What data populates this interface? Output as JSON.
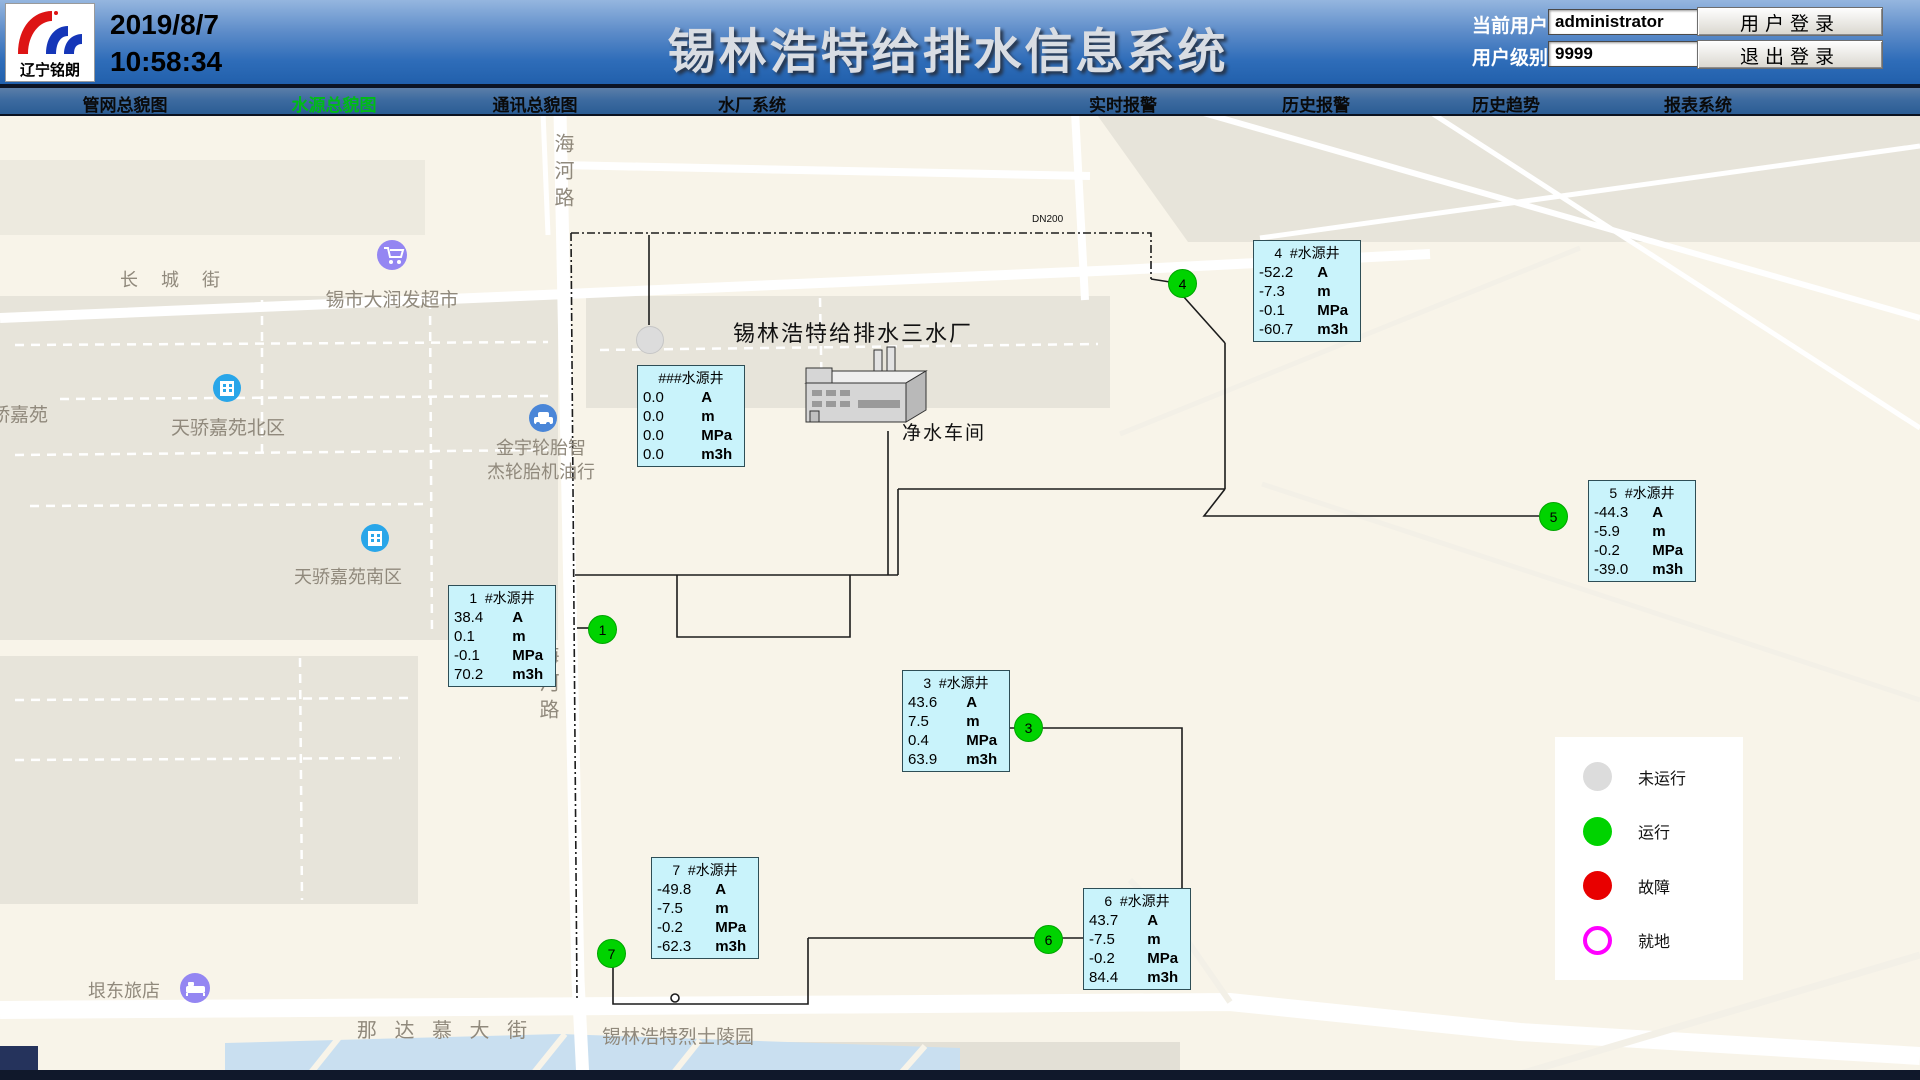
{
  "header": {
    "logo_text": "辽宁铭朗",
    "date": "2019/8/7",
    "time": "10:58:34",
    "title": "锡林浩特给排水信息系统",
    "current_user_label": "当前用户",
    "current_user_value": "administrator",
    "user_level_label": "用户级别",
    "user_level_value": "9999",
    "login_button": "用户登录",
    "logout_button": "退出登录"
  },
  "nav": {
    "items": [
      {
        "label": "管网总貌图",
        "active": false
      },
      {
        "label": "水源总貌图",
        "active": true
      },
      {
        "label": "通讯总貌图",
        "active": false
      },
      {
        "label": "水厂系统",
        "active": false
      },
      {
        "label": "实时报警",
        "active": false
      },
      {
        "label": "历史报警",
        "active": false
      },
      {
        "label": "历史趋势",
        "active": false
      },
      {
        "label": "报表系统",
        "active": false
      }
    ]
  },
  "plant": {
    "title": "锡林浩特给排水三水厂",
    "workshop_label": "净水车间",
    "pipe_label": "DN200"
  },
  "wells": [
    {
      "title": "###水源井",
      "rows": [
        {
          "v": "0.0",
          "u": "A"
        },
        {
          "v": "0.0",
          "u": "m"
        },
        {
          "v": "0.0",
          "u": "MPa"
        },
        {
          "v": "0.0",
          "u": "m3h"
        }
      ]
    },
    {
      "title": "1  #水源井",
      "rows": [
        {
          "v": "38.4",
          "u": "A"
        },
        {
          "v": "0.1",
          "u": "m"
        },
        {
          "v": "-0.1",
          "u": "MPa"
        },
        {
          "v": "70.2",
          "u": "m3h"
        }
      ]
    },
    {
      "title": "3  #水源井",
      "rows": [
        {
          "v": "43.6",
          "u": "A"
        },
        {
          "v": "7.5",
          "u": "m"
        },
        {
          "v": "0.4",
          "u": "MPa"
        },
        {
          "v": "63.9",
          "u": "m3h"
        }
      ]
    },
    {
      "title": "4  #水源井",
      "rows": [
        {
          "v": "-52.2",
          "u": "A"
        },
        {
          "v": "-7.3",
          "u": "m"
        },
        {
          "v": "-0.1",
          "u": "MPa"
        },
        {
          "v": "-60.7",
          "u": "m3h"
        }
      ]
    },
    {
      "title": "5  #水源井",
      "rows": [
        {
          "v": "-44.3",
          "u": "A"
        },
        {
          "v": "-5.9",
          "u": "m"
        },
        {
          "v": "-0.2",
          "u": "MPa"
        },
        {
          "v": "-39.0",
          "u": "m3h"
        }
      ]
    },
    {
      "title": "6  #水源井",
      "rows": [
        {
          "v": "43.7",
          "u": "A"
        },
        {
          "v": "-7.5",
          "u": "m"
        },
        {
          "v": "-0.2",
          "u": "MPa"
        },
        {
          "v": "84.4",
          "u": "m3h"
        }
      ]
    },
    {
      "title": "7  #水源井",
      "rows": [
        {
          "v": "-49.8",
          "u": "A"
        },
        {
          "v": "-7.5",
          "u": "m"
        },
        {
          "v": "-0.2",
          "u": "MPa"
        },
        {
          "v": "-62.3",
          "u": "m3h"
        }
      ]
    }
  ],
  "markers": {
    "m1": "1",
    "m3": "3",
    "m4": "4",
    "m5": "5",
    "m6": "6",
    "m7": "7"
  },
  "legend": {
    "items": [
      {
        "label": "未运行",
        "color": "#dcdcdc",
        "style": "filled"
      },
      {
        "label": "运行",
        "color": "#00d300",
        "style": "filled"
      },
      {
        "label": "故障",
        "color": "#e80000",
        "style": "filled"
      },
      {
        "label": "就地",
        "color": "#ff00ff",
        "style": "outline"
      }
    ]
  },
  "map": {
    "streets": {
      "changcheng": "长 城 街",
      "nadamu": "那 达 慕 大 街",
      "haihe": "海河路"
    },
    "pois": {
      "supermarket": "锡市大润发超市",
      "estate_west": "天骄嘉苑",
      "estate_north": "天骄嘉苑北区",
      "tire_shop_line1": "金宇轮胎智",
      "tire_shop_line2": "杰轮胎机油行",
      "estate_south": "天骄嘉苑南区",
      "hotel": "垠东旅店",
      "cemetery": "锡林浩特烈士陵园"
    }
  },
  "colors": {
    "well_box_bg": "#c9f3fb",
    "status_running": "#00d300",
    "status_stopped": "#dcdcdc",
    "status_fault": "#e80000",
    "status_local": "#ff00ff",
    "nav_active": "#00bb17",
    "header_blue": "#2f6db9",
    "water": "#c9dff0"
  }
}
